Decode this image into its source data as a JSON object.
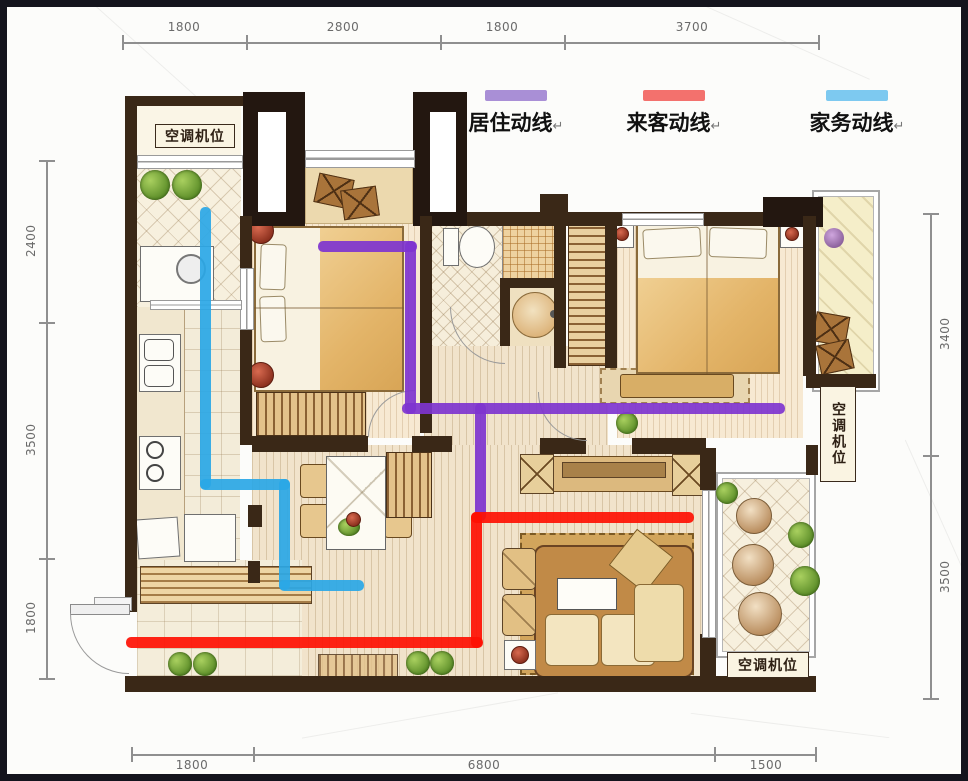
{
  "legend": {
    "items": [
      {
        "label": "居住动线",
        "mark": "↵",
        "color": "#a98fd6"
      },
      {
        "label": "来客动线",
        "mark": "↵",
        "color": "#f3716d"
      },
      {
        "label": "家务动线",
        "mark": "↵",
        "color": "#7dc9f0"
      }
    ]
  },
  "dimensions": {
    "top": [
      "1800",
      "2800",
      "1800",
      "3700"
    ],
    "bottom": [
      "1800",
      "6800",
      "1500"
    ],
    "left": [
      "2400",
      "3500",
      "1800"
    ],
    "right": [
      "3400",
      "3500"
    ]
  },
  "plan": {
    "ac_label_top_left": "空调机位",
    "ac_label_right": "空调机位",
    "ac_label_bottom_right": "空调机位"
  },
  "paths": {
    "resident": {
      "label": "居住动线",
      "color": "#7e34cf"
    },
    "guest": {
      "label": "来客动线",
      "color": "#fe1003"
    },
    "chore": {
      "label": "家务动线",
      "color": "#2aa7e6"
    }
  }
}
